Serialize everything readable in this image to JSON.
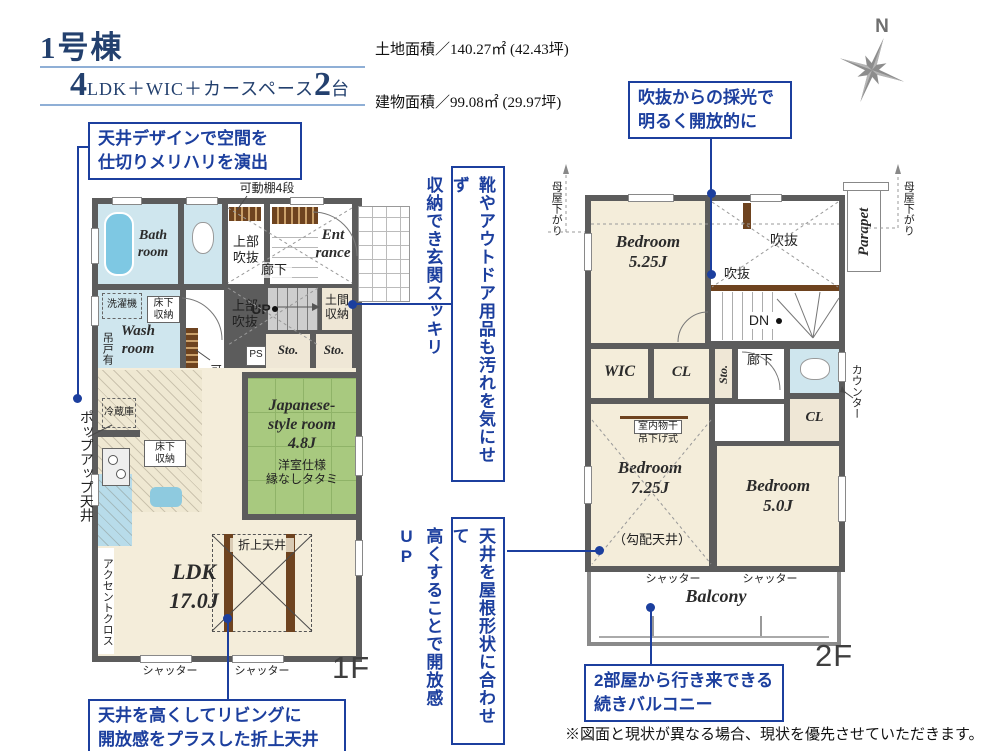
{
  "header": {
    "building": "1号棟",
    "plan_num1": "4",
    "plan_mid": "LDK＋WIC＋カースペース",
    "plan_num2": "2",
    "plan_tail": "台",
    "land_area": "土地面積／140.27㎡ (42.43坪)",
    "building_area": "建物面積／99.08㎡ (29.97坪)",
    "compass_n": "N"
  },
  "callouts": {
    "ceiling_design": "天井デザインで空間を\n仕切りメリハリを演出",
    "void_light": "吹抜からの採光で\n明るく開放的に",
    "entrance_storage": "靴やアウトドア用品も汚れを気にせず\n収納でき玄関スッキリ",
    "roof_ceiling": "天井を屋根形状に合わせて\n高くすることで開放感UP",
    "folded_ceiling": "天井を高くしてリビングに\n開放感をプラスした折上天井",
    "balcony_link": "2部屋から行き来できる\n続きバルコニー"
  },
  "floor1": {
    "label": "1F",
    "bath": "Bath\nroom",
    "wash": "Wash\nroom",
    "washer": "洗濯機",
    "hanging_door": "吊戸有",
    "underfloor1": "床下\n収納",
    "underfloor2": "床下\n収納",
    "fridge": "冷蔵庫",
    "hall_void_upper": "上部\n吹抜",
    "hall_void_lower": "上部\n吹抜",
    "corridor": "廊下",
    "entrance": "Ent\nrance",
    "up": "UP",
    "doma": "土間\n収納",
    "ps": "PS",
    "sto1": "Sto.",
    "sto2": "Sto.",
    "shelf_top": "可動棚4段",
    "shelf_side": "可動棚4段",
    "japanese": "Japanese-\nstyle room\n4.8J",
    "japanese_note": "洋室仕様\n縁なしタタミ",
    "ldk": "LDK\n17.0J",
    "orimage": "折上天井",
    "accent": "アクセントクロス",
    "popup": "ポップアップ天井",
    "shutter1": "シャッター",
    "shutter2": "シャッター"
  },
  "floor2": {
    "label": "2F",
    "bedroom1": "Bedroom\n5.25J",
    "bedroom2": "Bedroom\n7.25J",
    "bedroom2_note": "（勾配天井）",
    "bedroom3": "Bedroom\n5.0J",
    "void_large": "吹抜",
    "void_small": "吹抜",
    "dn": "DN",
    "wic": "WIC",
    "cl1": "CL",
    "cl2": "CL",
    "sto": "Sto.",
    "corridor": "廊下",
    "counter": "カウンター",
    "drying1": "室内物干",
    "drying2": "吊下げ式",
    "parapet": "Parapet",
    "moya_left": "母屋下がり",
    "moya_right": "母屋下がり",
    "balcony": "Balcony",
    "shutter1": "シャッター",
    "shutter2": "シャッター"
  },
  "disclaimer": "※図面と現状が異なる場合、現状を優先させていただきます。"
}
